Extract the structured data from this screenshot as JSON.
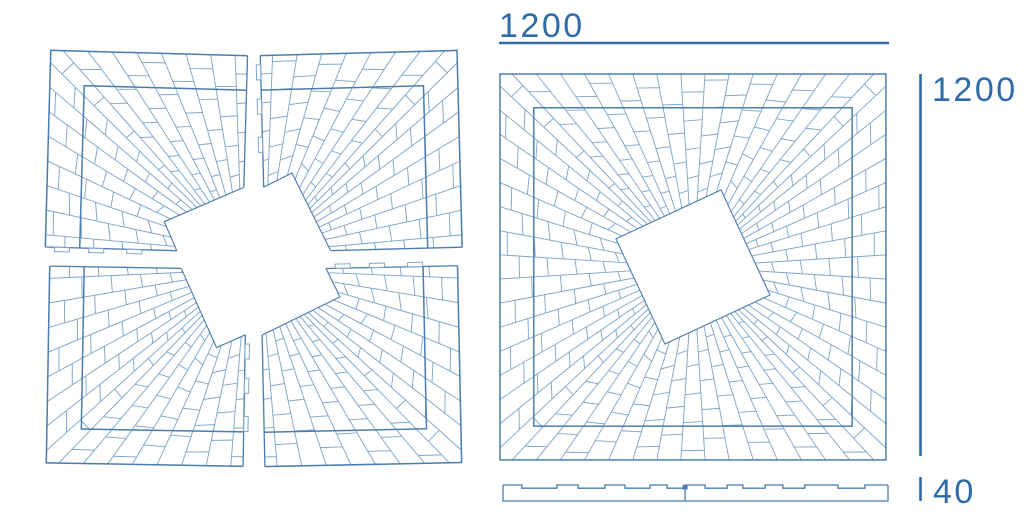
{
  "page": {
    "background": "#ffffff"
  },
  "figure": {
    "kind": "technical-line-drawing",
    "subject": "square sunburst parquet panel with rotated square center opening",
    "views": [
      "exploded-four-pieces",
      "assembled-top-view",
      "side-profile"
    ]
  },
  "dimensions": {
    "width_label": "1200",
    "height_label": "1200",
    "thickness_label": "40"
  },
  "colors": {
    "background": "#ffffff",
    "line_light": "#7fa6c9",
    "line_medium": "#4a7cae",
    "dimension": "#2f6ba8"
  },
  "drawing": {
    "panel_size": 1200,
    "inner_inset": 105,
    "hole_half_diagonal": 255,
    "hole_angle_deg": 20,
    "rays_per_side": 16,
    "plank_fraction": 0.22,
    "exploded": {
      "origin_x": 48,
      "origin_y": 53,
      "scale": 0.328,
      "gap_px": 18,
      "rotations_deg": [
        1.6,
        -1.5,
        1.0,
        -1.2
      ]
    },
    "assembled": {
      "origin_x": 500,
      "origin_y": 74,
      "scale": 0.3216
    },
    "tabs": {
      "positions": [
        0.07,
        0.33,
        0.62
      ],
      "width": 46,
      "depth": 13
    },
    "side_view": {
      "x": 503,
      "y": 485,
      "width": 385,
      "height": 16,
      "groove_depth": 3.2,
      "grooves": [
        [
          0.049,
          0.14
        ],
        [
          0.195,
          0.265
        ],
        [
          0.317,
          0.382
        ],
        [
          0.426,
          0.473
        ],
        [
          0.525,
          0.582
        ],
        [
          0.623,
          0.681
        ],
        [
          0.727,
          0.784
        ],
        [
          0.87,
          0.94
        ]
      ],
      "joint_x": 0.473
    }
  }
}
